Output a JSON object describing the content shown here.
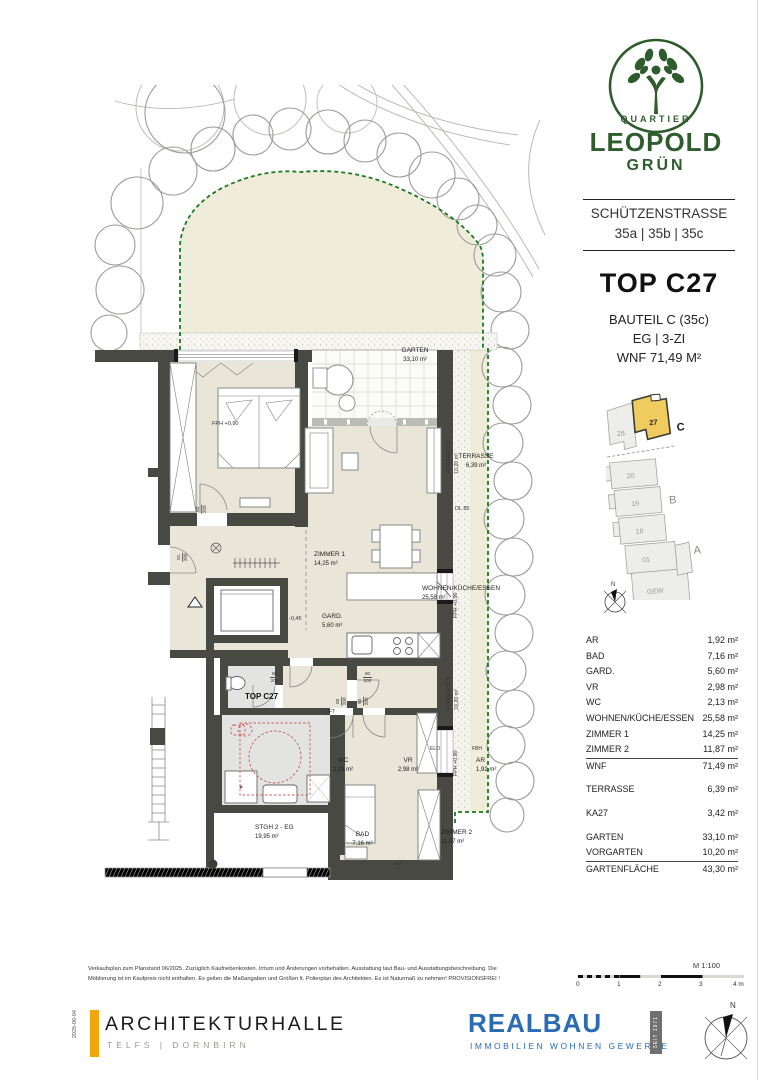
{
  "sidebar": {
    "logo": {
      "brand_top": "QUARTIER",
      "brand_main": "LEOPOLD",
      "brand_sub": "GRÜN"
    },
    "address": {
      "street": "SCHÜTZENSTRASSE",
      "numbers": "35a | 35b | 35c"
    },
    "unit_title": "TOP C27",
    "building": "BAUTEIL C (35c)",
    "floor_rooms": "EG   |   3-ZI",
    "living_area": "WNF 71,49 M²",
    "keyplan": {
      "u28": "28",
      "u27": "27",
      "u20": "20",
      "u19": "19",
      "u18": "18",
      "u01": "01",
      "gew": "GEW",
      "block_a": "A",
      "block_b": "B",
      "block_c": "C",
      "north": "N"
    },
    "areas": {
      "rows": [
        {
          "label": "AR",
          "value": "1,92 m²"
        },
        {
          "label": "BAD",
          "value": "7,16 m²"
        },
        {
          "label": "GARD.",
          "value": "5,60 m²"
        },
        {
          "label": "VR",
          "value": "2,98 m²"
        },
        {
          "label": "WC",
          "value": "2,13 m²"
        },
        {
          "label": "WOHNEN/KÜCHE/ESSEN",
          "value": "25,58 m²"
        },
        {
          "label": "ZIMMER 1",
          "value": "14,25 m²"
        },
        {
          "label": "ZIMMER 2",
          "value": "11,87 m²"
        },
        {
          "label": "WNF",
          "value": "71,49 m²"
        },
        {
          "label": "TERRASSE",
          "value": "6,39 m²"
        },
        {
          "label": "KA27",
          "value": "3,42 m²"
        },
        {
          "label": "GARTEN",
          "value": "33,10 m²"
        },
        {
          "label": "VORGARTEN",
          "value": "10,20 m²"
        },
        {
          "label": "GARTENFLÄCHE",
          "value": "43,30 m²"
        }
      ]
    },
    "scalebar": {
      "title": "M 1:100",
      "t0": "0",
      "t1": "1",
      "t2": "2",
      "t3": "3",
      "t4": "4 m"
    }
  },
  "plan": {
    "garten": {
      "name": "GARTEN",
      "area": "33,10 m²"
    },
    "terrasse": {
      "name": "TERRASSE",
      "area": "6,39 m²"
    },
    "zimmer1": {
      "name": "ZIMMER 1",
      "area": "14,25 m²"
    },
    "wohnen": {
      "name": "WOHNEN/KÜCHE/ESSEN",
      "area": "25,58 m²"
    },
    "gard": {
      "name": "GARD.",
      "area": "5,60 m²"
    },
    "wc": {
      "name": "WC",
      "area": "2,13 m²"
    },
    "vr": {
      "name": "VR",
      "area": "2,98 m²"
    },
    "ar": {
      "name": "AR",
      "area": "1,92 m²"
    },
    "bad": {
      "name": "BAD",
      "area": "7,16 m²"
    },
    "zimmer2": {
      "name": "ZIMMER 2",
      "area": "11,87 m²"
    },
    "stgh": {
      "name": "STGH 2 - EG",
      "area": "19,95 m²"
    },
    "lift": "LIFT",
    "unit_marker": "TOP C27",
    "dl85": "DL 85",
    "elo": "ELO",
    "fbh": "FBH",
    "wm": "WM",
    "fph": "FPH +0,90",
    "vorgarten_name": "VORGARTEN",
    "vorgarten_area": "10,20 m²",
    "level": "-0,45",
    "door_w1": "80",
    "door_h1": "200",
    "door_w2": "91",
    "door_h2": "205"
  },
  "disclaimer": {
    "line1": "Verkaufsplan zum Planstand 06/2025. Zuzüglich Kaufnebenkosten. Irrtum und Änderungen vorbehalten. Ausstattung laut Bau- und Ausstattungsbeschreibung. Die",
    "line2": "Möblierung ist im Kaufpreis nicht enthalten. Es gelten die Maßangaben und Größen lt. Polierplan des Architekten. Es ist Naturmaß zu nehmen!   PROVISIONSFREI !"
  },
  "footer": {
    "date": "2025-06-04",
    "architect": "ARCHITEKTURHALLE",
    "architect_sub": "TELFS | DORNBIRN",
    "realbau": "REALBAU",
    "realbau_sub": "IMMOBILIEN   WOHNEN   GEWERBE",
    "realbau_seit": "SEIT 1971",
    "north": "N"
  },
  "colors": {
    "brand_green": "#2f5c2c",
    "wall": "#494944",
    "realbau_blue": "#2a6cb4",
    "accent_yellow": "#f2a60a",
    "keyplan_highlight": "#f0cb5e",
    "garden_dash": "#1a7a1f"
  }
}
